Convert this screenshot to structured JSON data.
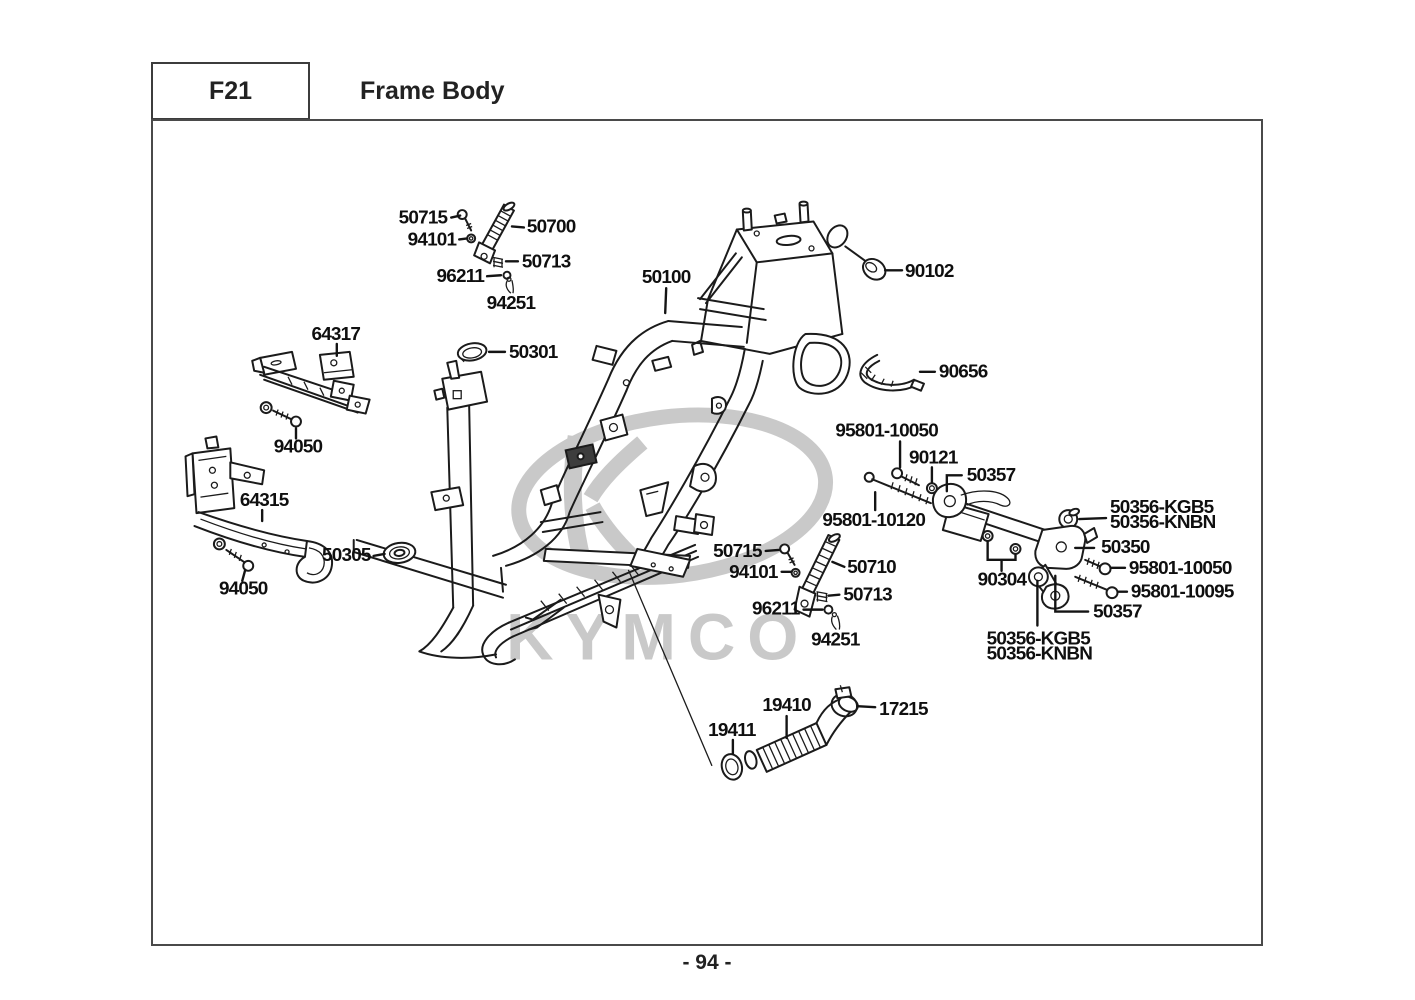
{
  "header": {
    "doc_code": "F21",
    "title": "Frame Body"
  },
  "footer": {
    "page_number": "- 94 -"
  },
  "watermark": {
    "brand": "KYMCO"
  },
  "callouts": [
    {
      "label": "50715"
    },
    {
      "label": "94101"
    },
    {
      "label": "50700"
    },
    {
      "label": "50713"
    },
    {
      "label": "96211"
    },
    {
      "label": "94251"
    },
    {
      "label": "50100"
    },
    {
      "label": "90102"
    },
    {
      "label": "90656"
    },
    {
      "label": "64317"
    },
    {
      "label": "50301"
    },
    {
      "label": "94050"
    },
    {
      "label": "64315"
    },
    {
      "label": "50305"
    },
    {
      "label": "94050"
    },
    {
      "label": "95801-10050"
    },
    {
      "label": "90121"
    },
    {
      "label": "50357"
    },
    {
      "label": "95801-10120"
    },
    {
      "label": "50356-KGB5"
    },
    {
      "label": "50356-KNBN"
    },
    {
      "label": "50350"
    },
    {
      "label": "95801-10050"
    },
    {
      "label": "95801-10095"
    },
    {
      "label": "50357"
    },
    {
      "label": "90304"
    },
    {
      "label": "50356-KGB5"
    },
    {
      "label": "50356-KNBN"
    },
    {
      "label": "50715"
    },
    {
      "label": "94101"
    },
    {
      "label": "50710"
    },
    {
      "label": "50713"
    },
    {
      "label": "96211"
    },
    {
      "label": "94251"
    },
    {
      "label": "19411"
    },
    {
      "label": "19410"
    },
    {
      "label": "17215"
    }
  ]
}
